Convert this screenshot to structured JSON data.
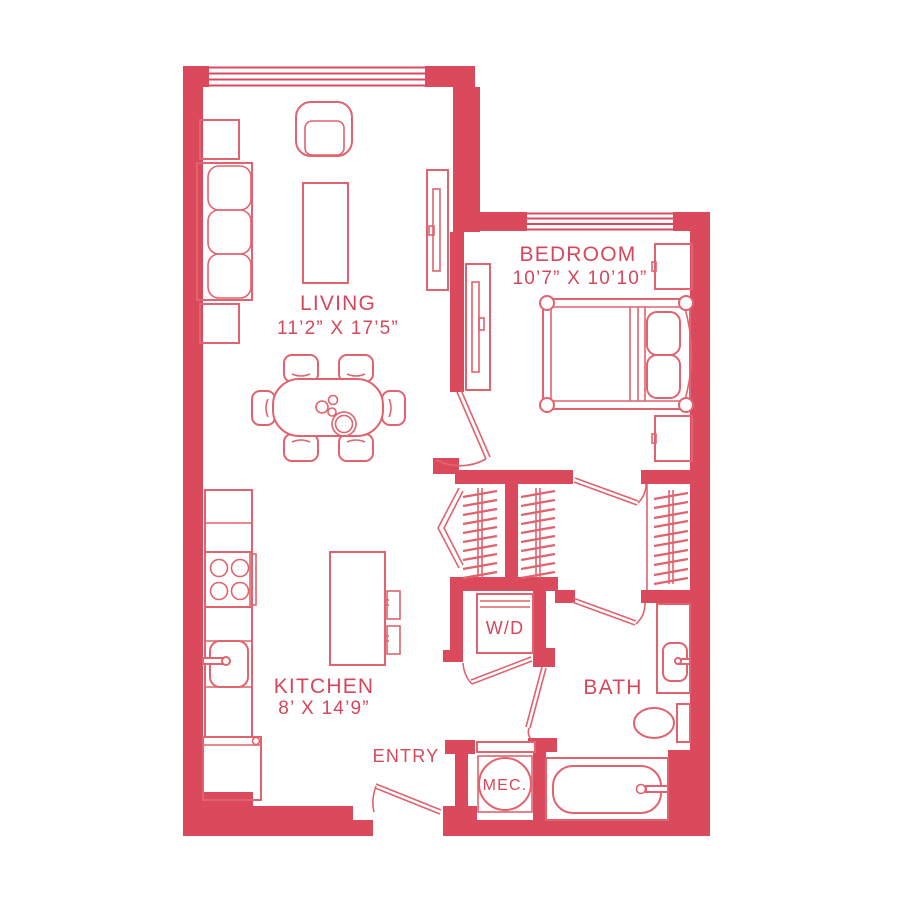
{
  "plan": {
    "colors": {
      "wall": "#DB4A5C",
      "line": "#E0636F",
      "text": "#D6475C",
      "bg": "#FFFFFF"
    },
    "rooms": {
      "living": {
        "name": "LIVING",
        "dims": "11’2” X 17’5”"
      },
      "bedroom": {
        "name": "BEDROOM",
        "dims": "10’7” X 10’10”"
      },
      "kitchen": {
        "name": "KITCHEN",
        "dims": "8’ X 14’9”"
      },
      "bath": {
        "name": "BATH"
      },
      "entry": {
        "name": "ENTRY"
      },
      "laundry": {
        "label": "W/D"
      },
      "mechanical": {
        "label": "MEC."
      }
    }
  }
}
